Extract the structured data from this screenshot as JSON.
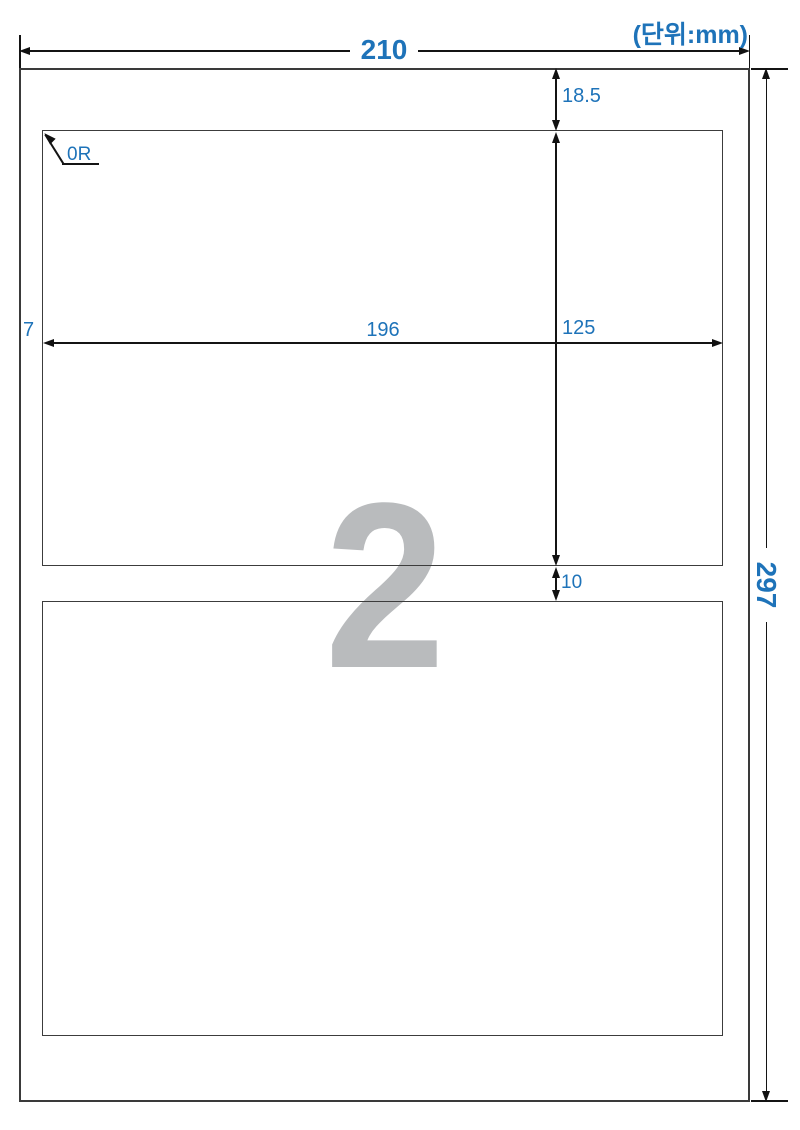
{
  "unit_note": "(단위:mm)",
  "sheet": {
    "width_mm": "210",
    "height_mm": "297",
    "top_margin_mm": "18.5",
    "left_margin_mm": "7",
    "label_width_mm": "196",
    "label_height_mm": "125",
    "row_gap_mm": "10",
    "corner_radius": "0R",
    "labels_per_sheet": "2"
  },
  "colors": {
    "dimension_blue": "#1e73b9",
    "outline_dark": "#3a3a3a",
    "dimension_line_black": "#141414",
    "watermark_gray": "#b9bbbd"
  }
}
